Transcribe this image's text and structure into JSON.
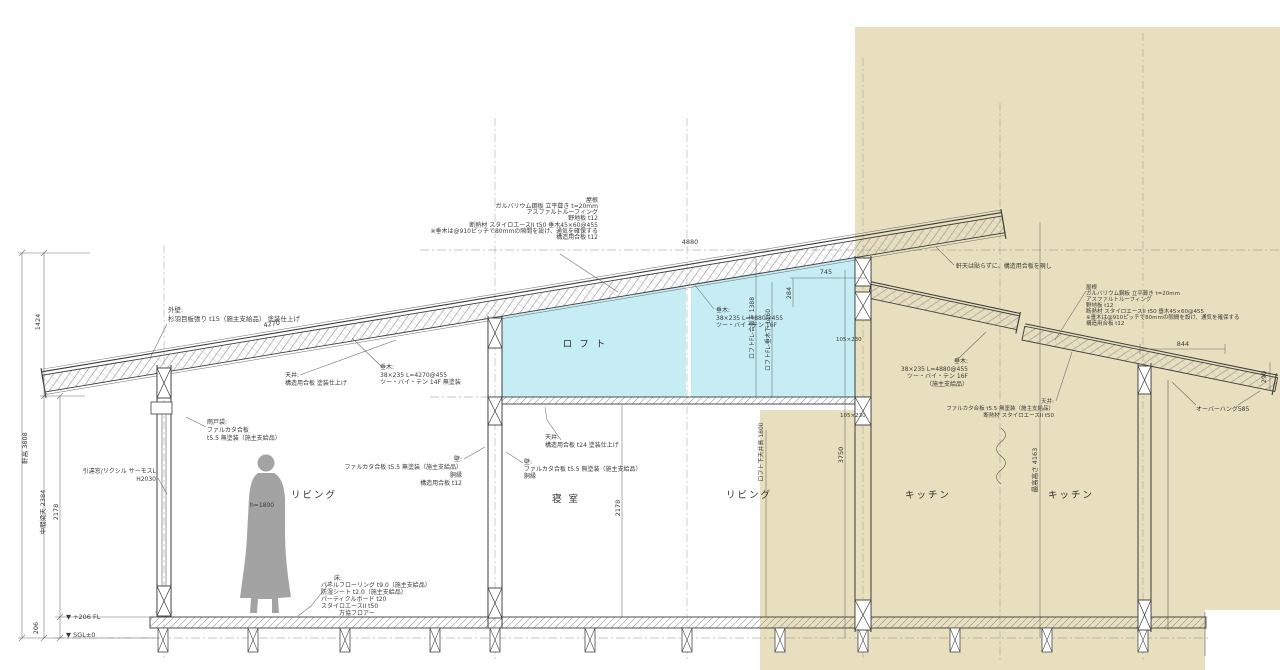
{
  "drawing": {
    "colors": {
      "paper": "#ffffff",
      "scan_beige": "#e7dfbe",
      "loft_highlight": "#c6edf4",
      "line": "#3c3c3c",
      "figure_gray": "#a3a3a3"
    },
    "rooms": {
      "living_left": "リビング",
      "bedroom": "寝 室",
      "loft": "ロ フ ト",
      "living_right": "リビング",
      "kitchen_left": "キッチン",
      "kitchen_right": "キッチン"
    },
    "specs": {
      "roof_left": {
        "lines": [
          "屋根",
          "ガルバリウム鋼板 立平葺き t=20mm",
          "アスファルトルーフィング",
          "野地板 t12",
          "断熱材 スタイロエースII t50 垂木45×60@455",
          "※垂木は@910ピッチで80mmの隙間を設け、通気を確保する",
          "構造用合板 t12"
        ]
      },
      "roof_right": {
        "lines": [
          "屋根",
          "ガルバリウム鋼板 立平葺き t=20mm",
          "アスファルトルーフィング",
          "野地板 t12",
          "断熱材 スタイロエースII t50 垂木45×60@455",
          "※垂木は@910ピッチで80mmの隙間を設け、通気を確保する",
          "構造用合板 t12"
        ]
      },
      "eave_note": "軒天は貼らずに、構造用合板を現し",
      "ext_wall": {
        "lines": [
          "外壁:",
          "杉羽目板張り t15（施主支給品） 塗装仕上げ"
        ]
      },
      "ceiling_slope": {
        "lines": [
          "天井:",
          "構造用合板 塗装仕上げ"
        ]
      },
      "rafter_left": {
        "lines": [
          "垂木:",
          "38×235 L=4270@455",
          "ツー・バイ・テン 14F 無塗装"
        ]
      },
      "rafter_loft": {
        "lines": [
          "垂木:",
          "38×235 L=4880@455",
          "ツー・バイ・テン 16F"
        ]
      },
      "rafter_kitchen": {
        "lines": [
          "垂木:",
          "38×235 L=4880@455",
          "ツー・バイ・テン 16F",
          "（施主支給品）"
        ]
      },
      "ceiling_loft": {
        "lines": [
          "天井:",
          "構造用合板 t24 塗装仕上げ"
        ]
      },
      "ceiling_kitchen": {
        "lines": [
          "天井:",
          "ファルカタ合板 t5.5 無塗装（施主支給品）",
          "断熱材 スタイロエースII t50"
        ]
      },
      "shutter_box": {
        "lines": [
          "雨戸袋:",
          "ファルカタ合板",
          "t5.5 無塗装（施主支給品）"
        ]
      },
      "window": {
        "lines": [
          "引違窓/リクシル サーモスL",
          "H2030"
        ]
      },
      "wall_center_left": {
        "lines": [
          "壁:",
          "ファルカタ合板 t5.5 無塗装（施主支給品）",
          "胴縁",
          "構造用合板 t12"
        ]
      },
      "wall_center_right": {
        "lines": [
          "壁:",
          "ファルカタ合板 t5.5 無塗装（施主支給品）",
          "胴縁"
        ]
      },
      "floor": {
        "lines": [
          "床:",
          "パネルフローリング t9.0（施主支給品）",
          "防湿シート t2.0（施主支給品）",
          "パーティクルボード t20",
          "スタイロエースII t50",
          "万協フロアー"
        ]
      },
      "beam_size": "105×230",
      "overhang_note": "オーバーハング585"
    },
    "dims": {
      "eave_height": "軒高 3808",
      "h1424": "1424",
      "mid_beam": "中間梁天 2384",
      "ch_living": "2178",
      "h206": "206",
      "fl_mark": "▼ +206 FL",
      "sgl_mark": "▼ SGL±0",
      "roof_4270": "4270",
      "roof_4880": "4880",
      "w745": "745",
      "h284": "284",
      "loft_plywood": "ロフトFL-合板下 1388",
      "loft_rafter": "ロフトFL-垂木下 1160",
      "ch_bedroom": "2178",
      "under_loft": "ロフト下天井高 1800",
      "h3750": "3750",
      "max_height": "最高高さ 4163",
      "w844": "844",
      "h290": "290",
      "figure_height": "h=1800"
    }
  }
}
